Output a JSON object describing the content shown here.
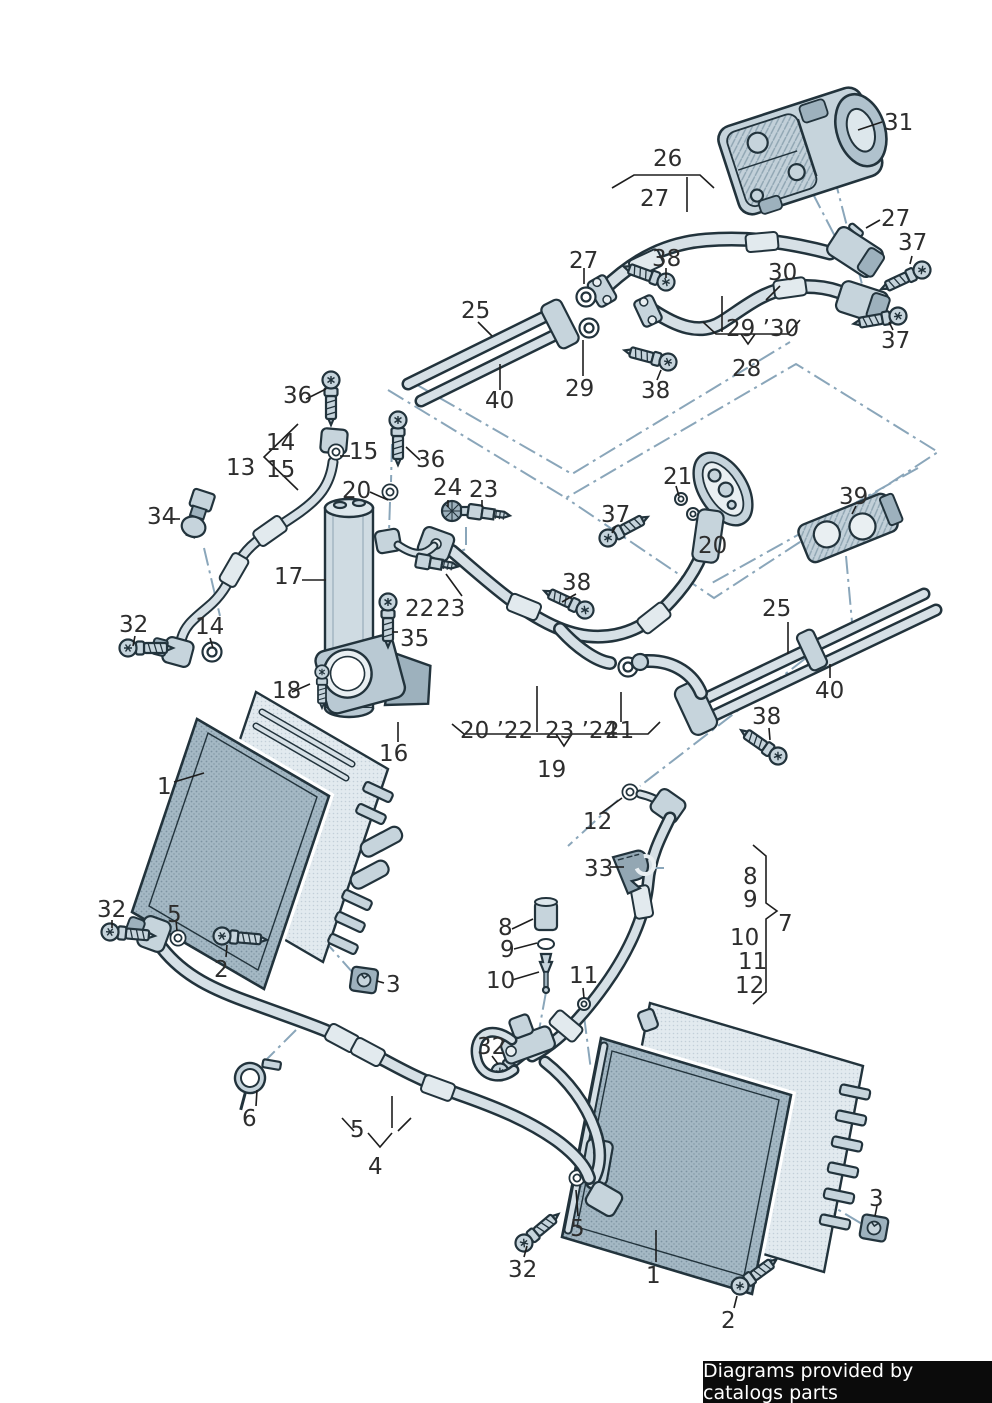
{
  "banner": {
    "text": "Diagrams provided by catalogs parts"
  },
  "colors": {
    "outline": "#22333c",
    "pipe_fill": "#d6e0e6",
    "metal_fill": "#c6d4dc",
    "condenser_fill": "#a4b8c4",
    "radiator_fill": "#e2eaef",
    "guide_line": "#8aa6ba",
    "label_color": "#2d2d2d",
    "banner_bg": "#0b0b0b",
    "banner_fg": "#ffffff"
  },
  "callouts": [
    {
      "part": "31",
      "text": "31"
    },
    {
      "part": "26",
      "text": "26"
    },
    {
      "part": "27",
      "text": "27"
    },
    {
      "part": "27",
      "text": "27"
    },
    {
      "part": "37",
      "text": "37"
    },
    {
      "part": "27",
      "text": "27"
    },
    {
      "part": "38",
      "text": "38"
    },
    {
      "part": "30",
      "text": "30"
    },
    {
      "part": "25",
      "text": "25"
    },
    {
      "part": "29-30",
      "text": "29 ’30"
    },
    {
      "part": "37",
      "text": "37"
    },
    {
      "part": "28",
      "text": "28"
    },
    {
      "part": "29",
      "text": "29"
    },
    {
      "part": "38",
      "text": "38"
    },
    {
      "part": "40",
      "text": "40"
    },
    {
      "part": "36",
      "text": "36"
    },
    {
      "part": "14",
      "text": "14"
    },
    {
      "part": "13",
      "text": "13"
    },
    {
      "part": "15",
      "text": "15"
    },
    {
      "part": "15",
      "text": "15"
    },
    {
      "part": "36",
      "text": "36"
    },
    {
      "part": "20",
      "text": "20"
    },
    {
      "part": "34",
      "text": "34"
    },
    {
      "part": "24",
      "text": "24"
    },
    {
      "part": "23",
      "text": "23"
    },
    {
      "part": "21",
      "text": "21"
    },
    {
      "part": "37",
      "text": "37"
    },
    {
      "part": "20",
      "text": "20"
    },
    {
      "part": "39",
      "text": "39"
    },
    {
      "part": "17",
      "text": "17"
    },
    {
      "part": "22",
      "text": "22"
    },
    {
      "part": "23",
      "text": "23"
    },
    {
      "part": "35",
      "text": "35"
    },
    {
      "part": "38",
      "text": "38"
    },
    {
      "part": "25",
      "text": "25"
    },
    {
      "part": "40",
      "text": "40"
    },
    {
      "part": "32",
      "text": "32"
    },
    {
      "part": "14",
      "text": "14"
    },
    {
      "part": "18",
      "text": "18"
    },
    {
      "part": "16",
      "text": "16"
    },
    {
      "part": "38",
      "text": "38"
    },
    {
      "part": "20-22",
      "text": "20 ’22"
    },
    {
      "part": "23-24",
      "text": "23 ’24"
    },
    {
      "part": "21",
      "text": "21"
    },
    {
      "part": "19",
      "text": "19"
    },
    {
      "part": "12",
      "text": "12"
    },
    {
      "part": "1",
      "text": "1"
    },
    {
      "part": "33",
      "text": "33"
    },
    {
      "part": "8",
      "text": "8"
    },
    {
      "part": "9",
      "text": "9"
    },
    {
      "part": "7",
      "text": "7"
    },
    {
      "part": "10",
      "text": "10"
    },
    {
      "part": "11",
      "text": "11"
    },
    {
      "part": "12",
      "text": "12"
    },
    {
      "part": "32",
      "text": "32"
    },
    {
      "part": "5",
      "text": "5"
    },
    {
      "part": "2",
      "text": "2"
    },
    {
      "part": "3",
      "text": "3"
    },
    {
      "part": "8",
      "text": "8"
    },
    {
      "part": "9",
      "text": "9"
    },
    {
      "part": "10",
      "text": "10"
    },
    {
      "part": "11",
      "text": "11"
    },
    {
      "part": "32",
      "text": "32"
    },
    {
      "part": "6",
      "text": "6"
    },
    {
      "part": "5",
      "text": "5"
    },
    {
      "part": "4",
      "text": "4"
    },
    {
      "part": "5",
      "text": "5"
    },
    {
      "part": "32",
      "text": "32"
    },
    {
      "part": "1",
      "text": "1"
    },
    {
      "part": "2",
      "text": "2"
    },
    {
      "part": "3",
      "text": "3"
    }
  ]
}
